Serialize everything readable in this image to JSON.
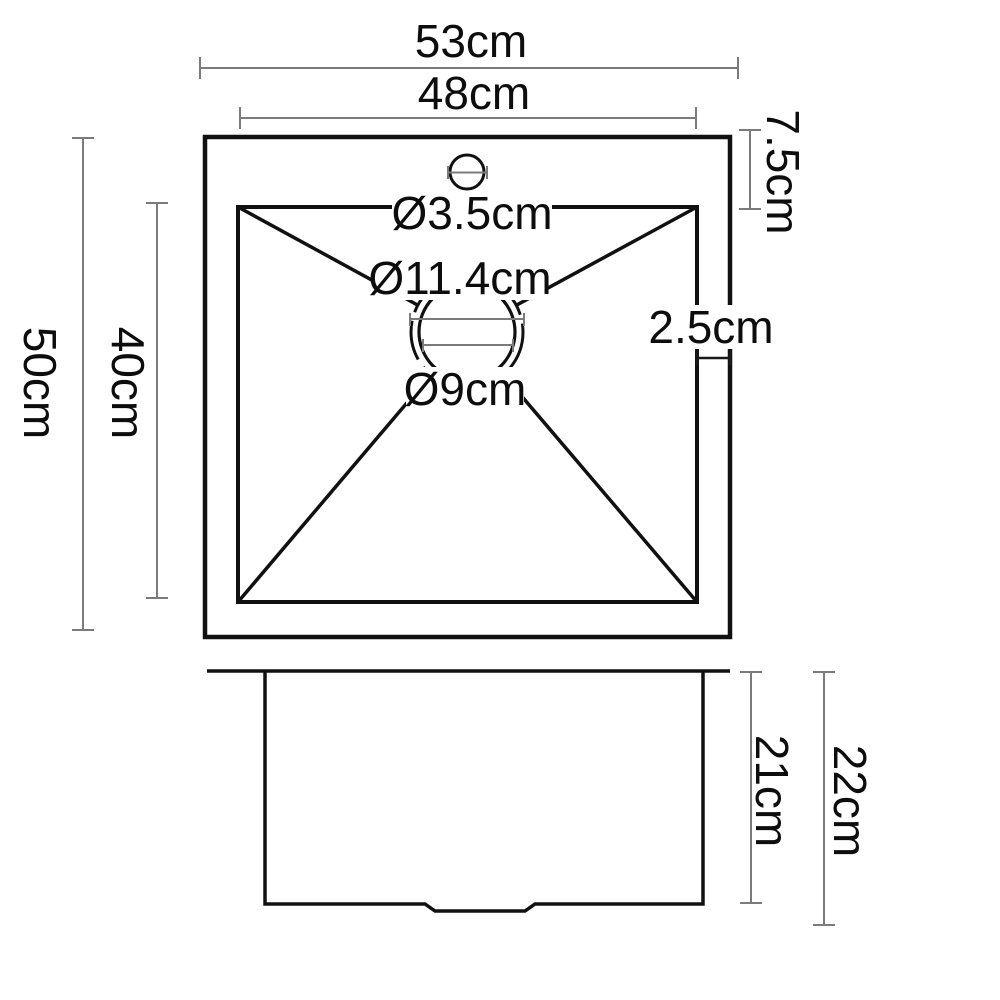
{
  "diagram": {
    "type": "sink-dimension-drawing",
    "colors": {
      "background": "#ffffff",
      "outline": "#111111",
      "dimension_line": "#7b7b7b",
      "text": "#0d0d0d"
    },
    "top_view": {
      "overall_width": "53cm",
      "inner_width": "48cm",
      "overall_depth": "50cm",
      "inner_depth": "40cm",
      "rim_top_offset": "7.5cm",
      "rim_right_offset": "2.5cm",
      "faucet_hole_diameter": "Ø3.5cm",
      "drain_flange_diameter": "Ø11.4cm",
      "drain_diameter": "Ø9cm"
    },
    "side_view": {
      "bowl_depth": "21cm",
      "overall_height": "22cm"
    }
  }
}
